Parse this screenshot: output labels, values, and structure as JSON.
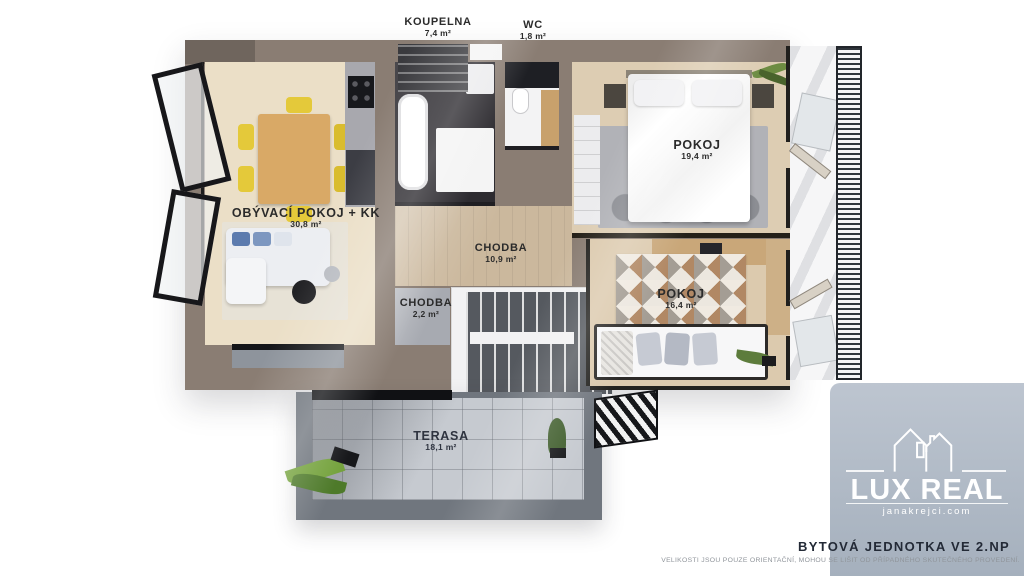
{
  "page": {
    "type": "floorplan-render"
  },
  "plan": {
    "rooms": [
      {
        "id": "koupelna",
        "name": "KOUPELNA",
        "area": "7,4 m²"
      },
      {
        "id": "wc",
        "name": "WC",
        "area": "1,8 m²"
      },
      {
        "id": "pokoj-19",
        "name": "POKOJ",
        "area": "19,4 m²"
      },
      {
        "id": "obyvaci-pokoj-kk",
        "name": "OBÝVACÍ POKOJ + KK",
        "area": "30,8 m²"
      },
      {
        "id": "chodba-10",
        "name": "CHODBA",
        "area": "10,9 m²"
      },
      {
        "id": "chodba-2",
        "name": "CHODBA",
        "area": "2,2 m²"
      },
      {
        "id": "pokoj-16",
        "name": "POKOJ",
        "area": "16,4 m²"
      },
      {
        "id": "terasa",
        "name": "TERASA",
        "area": "18,1 m²"
      }
    ]
  },
  "logo": {
    "brand": "LUX REAL",
    "website": "janakrejci.com"
  },
  "footer": {
    "title": "BYTOVÁ JEDNOTKA VE 2.NP",
    "disclaimer": "VELIKOSTI JSOU POUZE ORIENTAČNÍ, MOHOU SE LIŠIT OD PŘÍPADNÉHO SKUTEČNÉHO PROVEDENÍ."
  },
  "colors": {
    "outer_wall": "#8a7d73",
    "living_floor": "#ebdfc7",
    "hall_floor": "#cbb89d",
    "bathroom_floor": "#2d2b30",
    "terrace_floor": "#c6cad0",
    "terrace_wall": "#70767e",
    "chair_yellow": "#e4c93a",
    "logo_panel": "#aeb9c5",
    "footer_text": "#232a36"
  }
}
